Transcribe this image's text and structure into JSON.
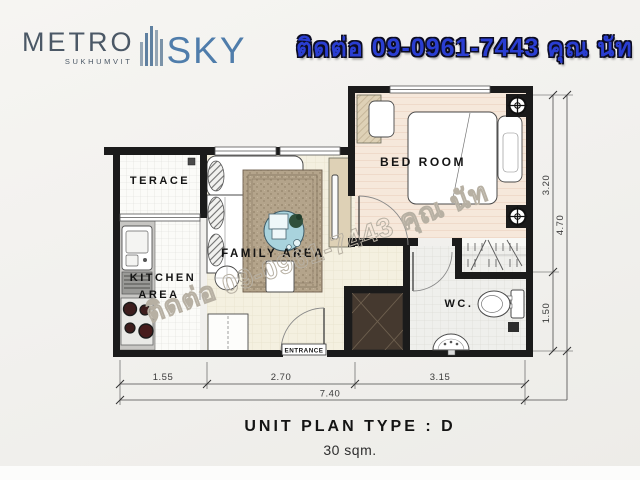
{
  "header": {
    "logo": {
      "metro": "METRO",
      "sukhumvit": "SUKHUMVIT",
      "sky": "SKY"
    },
    "contact": "ติดต่อ 09-0961-7443 คุณ นัท"
  },
  "watermark": "ติดต่อ 09-0961-7443 คุณ นัท",
  "plan": {
    "rooms": {
      "terrace": "TERACE",
      "kitchen_line1": "KITCHEN",
      "kitchen_line2": "AREA",
      "family": "FAMILY AREA",
      "bedroom": "BED ROOM",
      "wc": "WC.",
      "entrance": "ENTRANCE"
    },
    "dimensions": {
      "bottom_segments": [
        "1.55",
        "2.70",
        "3.15"
      ],
      "bottom_total": "7.40",
      "right_segments": [
        "3.20",
        "1.50"
      ],
      "right_total": "4.70"
    },
    "colors": {
      "wall": "#1b1b1b",
      "bedroom_floor": "#f6e8db",
      "family_floor": "#f4f0e0",
      "rug": "#b4a48b",
      "coffee_table_blue": "#a9d3dd",
      "wood_furniture": "#ded1b6",
      "shaft_dark": "#45392f"
    }
  },
  "footer": {
    "title": "UNIT PLAN TYPE : D",
    "subtitle": "30 sqm."
  },
  "brand_colors": {
    "metro_text": "#4b5866",
    "sky_text": "#4f7dab",
    "contact_text": "#2a3ed2"
  }
}
